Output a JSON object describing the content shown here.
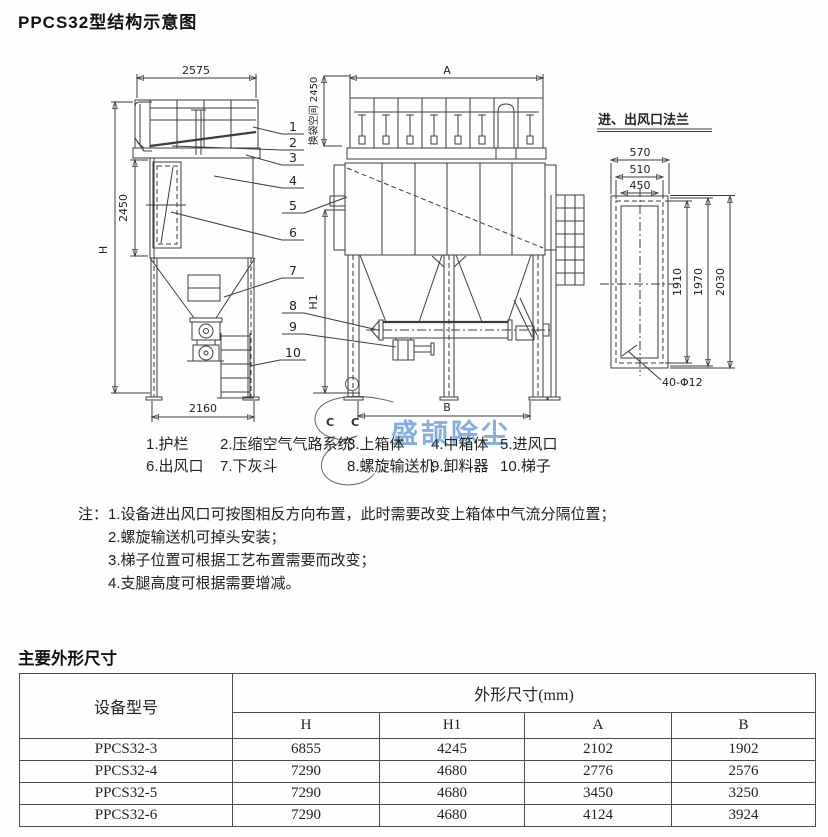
{
  "page": {
    "title": "PPCS32型结构示意图",
    "section2_title": "主要外形尺寸"
  },
  "diagram": {
    "side_view": {
      "dim_width_top": "2575",
      "dim_height_mid": "2450",
      "dim_height_total": "H",
      "dim_width_bottom": "2160",
      "dim_bag_space": "换袋空间 2450",
      "dim_h1": "H1"
    },
    "front_view": {
      "dim_a": "A",
      "dim_b": "B"
    },
    "flange_view": {
      "title": "进、出风口法兰",
      "dim_570": "570",
      "dim_510": "510",
      "dim_450": "450",
      "dim_1910": "1910",
      "dim_1970": "1970",
      "dim_2030": "2030",
      "bolt_label": "40-Φ12"
    },
    "callouts": [
      "1",
      "2",
      "3",
      "4",
      "5",
      "6",
      "7",
      "8",
      "9",
      "10"
    ],
    "watermark": {
      "logo_letters": [
        "C",
        "C"
      ],
      "text": "盛颉除尘"
    }
  },
  "parts_legend": {
    "row1": [
      "1.护栏",
      "2.压缩空气气路系统",
      "3.上箱体",
      "4.中箱体",
      "5.进风口"
    ],
    "row2": [
      "6.出风口",
      "7.下灰斗",
      "8.螺旋输送机",
      "9.卸料器",
      "10.梯子"
    ]
  },
  "notes": {
    "prefix": "注：",
    "items": [
      "1.设备进出风口可按图相反方向布置，此时需要改变上箱体中气流分隔位置；",
      "2.螺旋输送机可掉头安装；",
      "3.梯子位置可根据工艺布置需要而改变；",
      "4.支腿高度可根据需要增减。"
    ]
  },
  "table": {
    "col_model": "设备型号",
    "col_dims": "外形尺寸(mm)",
    "sub_cols": [
      "H",
      "H1",
      "A",
      "B"
    ],
    "rows": [
      [
        "PPCS32-3",
        "6855",
        "4245",
        "2102",
        "1902"
      ],
      [
        "PPCS32-4",
        "7290",
        "4680",
        "2776",
        "2576"
      ],
      [
        "PPCS32-5",
        "7290",
        "4680",
        "3450",
        "3250"
      ],
      [
        "PPCS32-6",
        "7290",
        "4680",
        "4124",
        "3924"
      ]
    ]
  }
}
